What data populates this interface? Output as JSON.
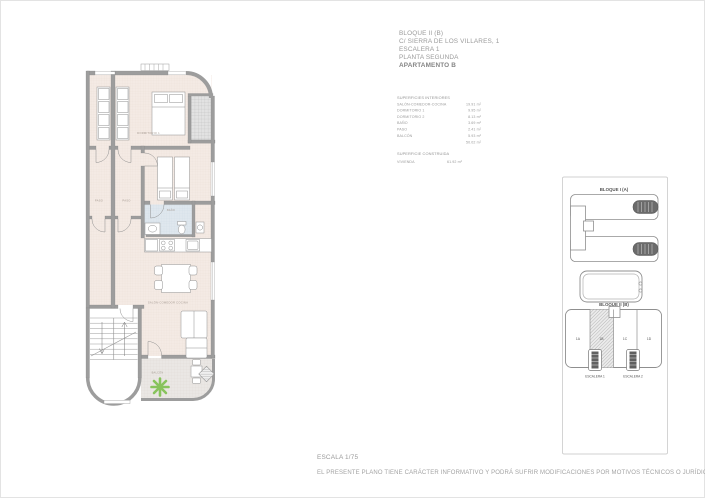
{
  "header": {
    "lines": [
      "BLOQUE II (B)",
      "C/ SIERRA DE LOS VILLARES, 1",
      "ESCALERA 1",
      "PLANTA SEGUNDA",
      "APARTAMENTO B"
    ]
  },
  "surfaces": {
    "title": "SUPERFICIES INTERIORES",
    "rows": [
      {
        "label": "SALÓN-COMEDOR-COCINA",
        "value": "19.91 m²"
      },
      {
        "label": "DORMITORIO 1",
        "value": "9.95 m²"
      },
      {
        "label": "DORMITORIO 2",
        "value": "8.13 m²"
      },
      {
        "label": "BAÑO",
        "value": "3.69 m²"
      },
      {
        "label": "PASO",
        "value": "2.41 m²"
      },
      {
        "label": "BALCÓN",
        "value": "5.93 m²"
      }
    ],
    "total_value": "50.02 m²"
  },
  "built": {
    "title": "SUPERFICIE CONSTRUIDA",
    "label": "VIVIENDA",
    "value": "61.92 m²"
  },
  "plan_labels": {
    "dormitorio1": "DORMITORIO 1",
    "paso": "PASO",
    "bano": "BAÑO",
    "salon": "SALÓN-COMEDOR COCINA",
    "balcon": "BALCÓN"
  },
  "site": {
    "bloque_a": "BLOQUE I (A)",
    "bloque_b": "BLOQUE II (B)",
    "units": [
      "1A",
      "1B",
      "1C",
      "1D"
    ],
    "escalera_1": "ESCALERA 1",
    "escalera_2": "ESCALERA 2"
  },
  "footer": {
    "scale": "ESCALA 1/75",
    "disclaimer": "EL PRESENTE PLANO TIENE CARÁCTER INFORMATIVO Y PODRÁ SUFRIR MODIFICACIONES POR MOTIVOS TÉCNICOS O JURÍDICOS"
  },
  "colors": {
    "floor": "#f4eae4",
    "wall": "#9d9d9d",
    "bathroom": "#dfe7ee",
    "balcony": "#eae7e4",
    "plant": "#7ec04f",
    "stair_block": "#666666"
  }
}
